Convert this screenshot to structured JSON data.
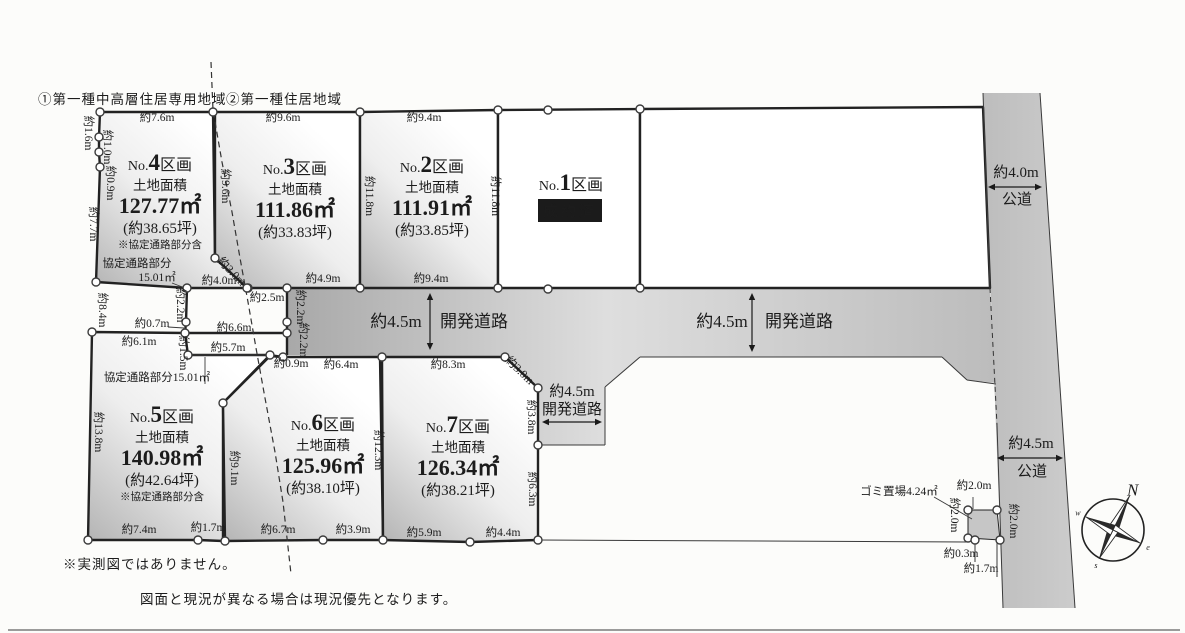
{
  "zoning": {
    "zone1": "①第一種中高層住居専用地域",
    "zone2": "②第一種住居地域"
  },
  "notes": {
    "note1": "※実測図ではありません。",
    "note2": "図面と現況が異なる場合は現況優先となります。"
  },
  "colors": {
    "line": "#222222",
    "plot_dark": "#b4b4b4",
    "plot_light": "#ffffff",
    "road_dark": "#a8a8a8",
    "road_light": "#dedede",
    "sold_bg": "#1b1b1b",
    "sold_text": "#ffffff",
    "garbage_fill": "#c6c6c6"
  },
  "plots": [
    {
      "prefix": "No.",
      "num": "4",
      "suffix": "区画",
      "area_title": "土地面積",
      "area": "127.77㎡",
      "tsubo": "(約38.65坪)",
      "note": "※協定通路部分含",
      "cx": 160,
      "cy": 170,
      "shaded": true,
      "poly": [
        [
          100,
          112
        ],
        [
          213,
          112
        ],
        [
          215,
          258
        ],
        [
          247,
          288
        ],
        [
          187,
          288
        ],
        [
          96,
          282
        ],
        [
          100,
          167
        ],
        [
          99,
          152
        ],
        [
          99,
          137
        ]
      ]
    },
    {
      "prefix": "No.",
      "num": "3",
      "suffix": "区画",
      "area_title": "土地面積",
      "area": "111.86㎡",
      "tsubo": "(約33.83坪)",
      "cx": 295,
      "cy": 174,
      "shaded": true,
      "poly": [
        [
          215,
          112
        ],
        [
          360,
          112
        ],
        [
          360,
          288
        ],
        [
          247,
          288
        ],
        [
          215,
          258
        ]
      ]
    },
    {
      "prefix": "No.",
      "num": "2",
      "suffix": "区画",
      "area_title": "土地面積",
      "area": "111.91㎡",
      "tsubo": "(約33.85坪)",
      "cx": 432,
      "cy": 172,
      "shaded": true,
      "poly": [
        [
          360,
          112
        ],
        [
          498,
          110
        ],
        [
          498,
          288
        ],
        [
          360,
          288
        ]
      ]
    },
    {
      "prefix": "No.",
      "num": "1",
      "suffix": "区画",
      "sold": "成約済",
      "cx": 571,
      "cy": 190,
      "shaded": false,
      "poly": [
        [
          498,
          110
        ],
        [
          640,
          109
        ],
        [
          640,
          288
        ],
        [
          498,
          288
        ]
      ]
    },
    {
      "prefix": "No.",
      "num": "5",
      "suffix": "区画",
      "area_title": "土地面積",
      "area": "140.98㎡",
      "tsubo": "(約42.64坪)",
      "note": "※協定通路部分含",
      "cx": 162,
      "cy": 422,
      "shaded": true,
      "poly": [
        [
          92,
          332
        ],
        [
          185,
          333
        ],
        [
          188,
          355
        ],
        [
          270,
          355
        ],
        [
          223,
          403
        ],
        [
          223,
          541
        ],
        [
          198,
          540
        ],
        [
          88,
          540
        ]
      ]
    },
    {
      "prefix": "No.",
      "num": "6",
      "suffix": "区画",
      "area_title": "土地面積",
      "area": "125.96㎡",
      "tsubo": "(約38.10坪)",
      "cx": 323,
      "cy": 430,
      "shaded": true,
      "poly": [
        [
          223,
          403
        ],
        [
          270,
          356
        ],
        [
          283,
          357
        ],
        [
          380,
          357
        ],
        [
          383,
          540
        ],
        [
          323,
          540
        ],
        [
          225,
          541
        ]
      ]
    },
    {
      "prefix": "No.",
      "num": "7",
      "suffix": "区画",
      "area_title": "土地面積",
      "area": "126.34㎡",
      "tsubo": "(約38.21坪)",
      "cx": 458,
      "cy": 432,
      "shaded": true,
      "poly": [
        [
          382,
          357
        ],
        [
          505,
          357
        ],
        [
          538,
          388
        ],
        [
          538,
          540
        ],
        [
          470,
          542
        ],
        [
          383,
          540
        ]
      ]
    },
    {
      "prefix": "",
      "num": "",
      "suffix": "",
      "cx": 0,
      "cy": 0,
      "shaded": false,
      "blank": true,
      "poly": [
        [
          640,
          109
        ],
        [
          983,
          107
        ],
        [
          990,
          288
        ],
        [
          640,
          288
        ]
      ]
    }
  ],
  "dimensions": [
    {
      "t": "約7.6m",
      "x": 157,
      "y": 121
    },
    {
      "t": "約9.6m",
      "x": 283,
      "y": 121
    },
    {
      "t": "約9.4m",
      "x": 424,
      "y": 121
    },
    {
      "t": "約1.6m",
      "x": 85,
      "y": 133,
      "r": 90
    },
    {
      "t": "約1.0m",
      "x": 104,
      "y": 147,
      "r": 90
    },
    {
      "t": "約0.9m",
      "x": 107,
      "y": 183,
      "r": 90
    },
    {
      "t": "約7.7m",
      "x": 90,
      "y": 224,
      "r": 90
    },
    {
      "t": "約8.4m",
      "x": 99,
      "y": 310,
      "r": 90
    },
    {
      "t": "約13.8m",
      "x": 95,
      "y": 432,
      "r": 90
    },
    {
      "t": "約9.6m",
      "x": 222,
      "y": 186,
      "r": 90
    },
    {
      "t": "約11.8m",
      "x": 366,
      "y": 196,
      "r": 90
    },
    {
      "t": "約11.8m",
      "x": 492,
      "y": 196,
      "r": 90
    },
    {
      "t": "約3.0m",
      "x": 229,
      "y": 274,
      "r": 46
    },
    {
      "t": "約4.0m",
      "x": 219,
      "y": 284
    },
    {
      "t": "約2.5m",
      "x": 267,
      "y": 301
    },
    {
      "t": "約4.9m",
      "x": 323,
      "y": 282
    },
    {
      "t": "約9.4m",
      "x": 431,
      "y": 282
    },
    {
      "t": "約2.2m",
      "x": 177,
      "y": 305,
      "r": 90
    },
    {
      "t": "約2.2m",
      "x": 297,
      "y": 307,
      "r": 90
    },
    {
      "t": "約2.2m",
      "x": 300,
      "y": 340,
      "r": 90
    },
    {
      "t": "約0.7m",
      "x": 152,
      "y": 327
    },
    {
      "t": "約6.6m",
      "x": 234,
      "y": 331
    },
    {
      "t": "約6.1m",
      "x": 139,
      "y": 345
    },
    {
      "t": "約1.5m",
      "x": 180,
      "y": 353,
      "r": 90
    },
    {
      "t": "約5.7m",
      "x": 228,
      "y": 351
    },
    {
      "t": "協定通路部分",
      "x": 137,
      "y": 267
    },
    {
      "t": "15.01㎡",
      "x": 157,
      "y": 281
    },
    {
      "t": "協定通路部分15.01㎡",
      "x": 157,
      "y": 381
    },
    {
      "t": "約0.9m",
      "x": 291,
      "y": 367
    },
    {
      "t": "約6.4m",
      "x": 341,
      "y": 368
    },
    {
      "t": "約8.3m",
      "x": 448,
      "y": 368
    },
    {
      "t": "約3.0m",
      "x": 517,
      "y": 373,
      "r": 44
    },
    {
      "t": "約3.8m",
      "x": 528,
      "y": 417,
      "r": 90
    },
    {
      "t": "約6.3m",
      "x": 529,
      "y": 489,
      "r": 90
    },
    {
      "t": "約12.3m",
      "x": 375,
      "y": 450,
      "r": 90
    },
    {
      "t": "約9.1m",
      "x": 231,
      "y": 468,
      "r": 90
    },
    {
      "t": "約7.4m",
      "x": 139,
      "y": 533
    },
    {
      "t": "約1.7m",
      "x": 208,
      "y": 531
    },
    {
      "t": "約6.7m",
      "x": 278,
      "y": 533
    },
    {
      "t": "約3.9m",
      "x": 353,
      "y": 533
    },
    {
      "t": "約5.9m",
      "x": 424,
      "y": 536
    },
    {
      "t": "約4.4m",
      "x": 503,
      "y": 536
    },
    {
      "t": "ゴミ置場4.24㎡",
      "x": 899,
      "y": 495
    },
    {
      "t": "約2.0m",
      "x": 974,
      "y": 489
    },
    {
      "t": "約2.0m",
      "x": 951,
      "y": 515,
      "r": 90
    },
    {
      "t": "約2.0m",
      "x": 1010,
      "y": 521,
      "r": 90
    },
    {
      "t": "約0.3m",
      "x": 961,
      "y": 557
    },
    {
      "t": "約1.7m",
      "x": 981,
      "y": 572
    }
  ],
  "road_labels": [
    {
      "t": "約4.5m",
      "x": 396,
      "y": 327,
      "fs": 17
    },
    {
      "t": "開発道路",
      "x": 474,
      "y": 327,
      "fs": 17
    },
    {
      "t": "約4.5m",
      "x": 722,
      "y": 327,
      "fs": 17
    },
    {
      "t": "開発道路",
      "x": 799,
      "y": 327,
      "fs": 17
    },
    {
      "t": "約4.5m",
      "x": 572,
      "y": 396,
      "fs": 15
    },
    {
      "t": "開発道路",
      "x": 572,
      "y": 414,
      "fs": 15
    },
    {
      "t": "約4.0m",
      "x": 1016,
      "y": 177,
      "fs": 15
    },
    {
      "t": "公道",
      "x": 1017,
      "y": 204,
      "fs": 15
    },
    {
      "t": "約4.5m",
      "x": 1031,
      "y": 448,
      "fs": 15
    },
    {
      "t": "公道",
      "x": 1032,
      "y": 476,
      "fs": 15
    }
  ],
  "compass": {
    "n": "N",
    "e": "e",
    "s": "s",
    "w": "w",
    "cx": 1113,
    "cy": 530,
    "rot": 26
  },
  "geometry": {
    "road_band": [
      [
        287,
        288
      ],
      [
        990,
        288
      ],
      [
        996,
        383
      ],
      [
        967,
        380
      ],
      [
        942,
        357
      ],
      [
        640,
        357
      ],
      [
        605,
        387
      ],
      [
        605,
        445
      ],
      [
        538,
        445
      ],
      [
        538,
        388
      ],
      [
        505,
        357
      ],
      [
        287,
        355
      ]
    ],
    "road_vertical": [
      [
        983,
        93
      ],
      [
        1040,
        93
      ],
      [
        1075,
        608
      ],
      [
        1003,
        608
      ]
    ],
    "garbage_box": [
      [
        968,
        510
      ],
      [
        997,
        510
      ],
      [
        1000,
        540
      ],
      [
        968,
        538
      ]
    ],
    "thick_segments": [
      [
        [
          187,
          288
        ],
        [
          186,
          322
        ]
      ],
      [
        [
          186,
          322
        ],
        [
          185,
          333
        ]
      ],
      [
        [
          185,
          333
        ],
        [
          287,
          333
        ]
      ],
      [
        [
          287,
          288
        ],
        [
          287,
          355
        ]
      ],
      [
        [
          270,
          355
        ],
        [
          283,
          357
        ]
      ]
    ],
    "thin_segments": [
      [
        [
          188,
          355
        ],
        [
          270,
          355
        ]
      ],
      [
        [
          538,
          445
        ],
        [
          605,
          445
        ]
      ],
      [
        [
          605,
          445
        ],
        [
          605,
          387
        ]
      ],
      [
        [
          605,
          387
        ],
        [
          640,
          357
        ]
      ],
      [
        [
          640,
          357
        ],
        [
          942,
          357
        ]
      ],
      [
        [
          942,
          357
        ],
        [
          967,
          380
        ]
      ],
      [
        [
          967,
          380
        ],
        [
          996,
          384
        ]
      ],
      [
        [
          538,
          540
        ],
        [
          968,
          542
        ]
      ],
      [
        [
          983,
          93
        ],
        [
          990,
          288
        ]
      ],
      [
        [
          997,
          425
        ],
        [
          1003,
          608
        ]
      ],
      [
        [
          1040,
          93
        ],
        [
          1075,
          608
        ]
      ],
      [
        [
          975,
          540
        ],
        [
          975,
          562
        ]
      ],
      [
        [
          997,
          540
        ],
        [
          997,
          577
        ]
      ],
      [
        [
          8,
          630
        ],
        [
          1180,
          630
        ]
      ]
    ],
    "pointer_segments": [
      [
        [
          172,
          283
        ],
        [
          190,
          290
        ]
      ],
      [
        [
          168,
          327
        ],
        [
          184,
          328
        ]
      ],
      [
        [
          205,
          357
        ],
        [
          205,
          384
        ]
      ],
      [
        [
          934,
          497
        ],
        [
          972,
          519
        ]
      ],
      [
        [
          973,
          497
        ],
        [
          973,
          509
        ]
      ]
    ],
    "dashed_zone_path": "M211,62 L213,110 L222,162 L232,212 L240,258 L248,302 L256,348 L265,398 L275,452 L283,502 L289,556 L291,574",
    "dashed_segments": [
      [
        [
          990,
          288
        ],
        [
          997,
          425
        ]
      ]
    ],
    "arrows": [
      {
        "x1": 430,
        "y1": 293,
        "x2": 430,
        "y2": 350
      },
      {
        "x1": 752,
        "y1": 293,
        "x2": 752,
        "y2": 352
      },
      {
        "x1": 542,
        "y1": 422,
        "x2": 602,
        "y2": 422
      },
      {
        "x1": 988,
        "y1": 187,
        "x2": 1042,
        "y2": 187
      },
      {
        "x1": 997,
        "y1": 458,
        "x2": 1063,
        "y2": 458
      }
    ],
    "circles": [
      [
        100,
        112
      ],
      [
        213,
        112
      ],
      [
        360,
        112
      ],
      [
        498,
        110
      ],
      [
        548,
        110
      ],
      [
        640,
        109
      ],
      [
        99,
        137
      ],
      [
        99,
        152
      ],
      [
        100,
        167
      ],
      [
        96,
        282
      ],
      [
        92,
        332
      ],
      [
        88,
        540
      ],
      [
        187,
        288
      ],
      [
        248,
        288
      ],
      [
        287,
        288
      ],
      [
        186,
        322
      ],
      [
        185,
        333
      ],
      [
        287,
        322
      ],
      [
        287,
        333
      ],
      [
        188,
        355
      ],
      [
        270,
        355
      ],
      [
        283,
        357
      ],
      [
        215,
        258
      ],
      [
        247,
        288
      ],
      [
        360,
        288
      ],
      [
        498,
        288
      ],
      [
        548,
        289
      ],
      [
        640,
        288
      ],
      [
        223,
        403
      ],
      [
        225,
        541
      ],
      [
        198,
        540
      ],
      [
        323,
        540
      ],
      [
        382,
        357
      ],
      [
        383,
        540
      ],
      [
        470,
        542
      ],
      [
        505,
        357
      ],
      [
        538,
        388
      ],
      [
        538,
        445
      ],
      [
        538,
        540
      ],
      [
        968,
        510
      ],
      [
        997,
        510
      ],
      [
        968,
        538
      ],
      [
        975,
        540
      ],
      [
        1000,
        540
      ]
    ],
    "sold_box": {
      "x": 538,
      "y": 199,
      "w": 64,
      "h": 23
    }
  }
}
